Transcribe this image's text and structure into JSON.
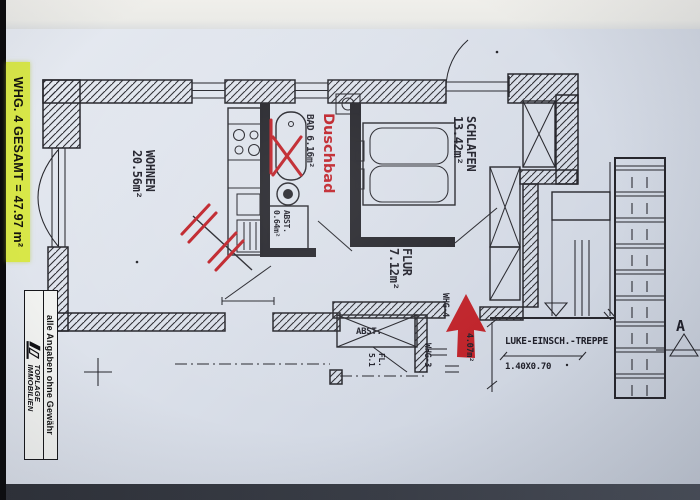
{
  "plan": {
    "side_label": "WHG. 4 GESAMT = 47.97 m²",
    "rooms": {
      "wohnen": {
        "name": "WOHNEN",
        "area": "20.56m²"
      },
      "bad": {
        "name": "BAD",
        "area": "6.16m²"
      },
      "bad_abst": {
        "name": "ABST.",
        "area": "0.64m²"
      },
      "schlafen": {
        "name": "SCHLAFEN",
        "area": "13.42m²"
      },
      "flur": {
        "name": "FLUR",
        "area": "7.12m²"
      },
      "abst": {
        "name": "ABST."
      },
      "fl": {
        "name": "FL.",
        "area": "5.1"
      }
    },
    "red_annotations": {
      "duschbad": "Duschbad"
    },
    "labels": {
      "whg4": "WHG-4",
      "whg3": "WHG-3",
      "wf_area": "4.07m²",
      "treppe": "LUKE-EINSCH.-TREPPE",
      "treppe_size": "1.40X0.70",
      "section": "A"
    }
  },
  "stamp": {
    "disclaimer": "alle Angaben ohne Gewähr",
    "brand_top": "TOPLAGE",
    "brand_bottom": "IMMOBILIEN"
  },
  "colors": {
    "ink": "#26262c",
    "red": "#bf2128",
    "highlight": "#d8e748"
  }
}
